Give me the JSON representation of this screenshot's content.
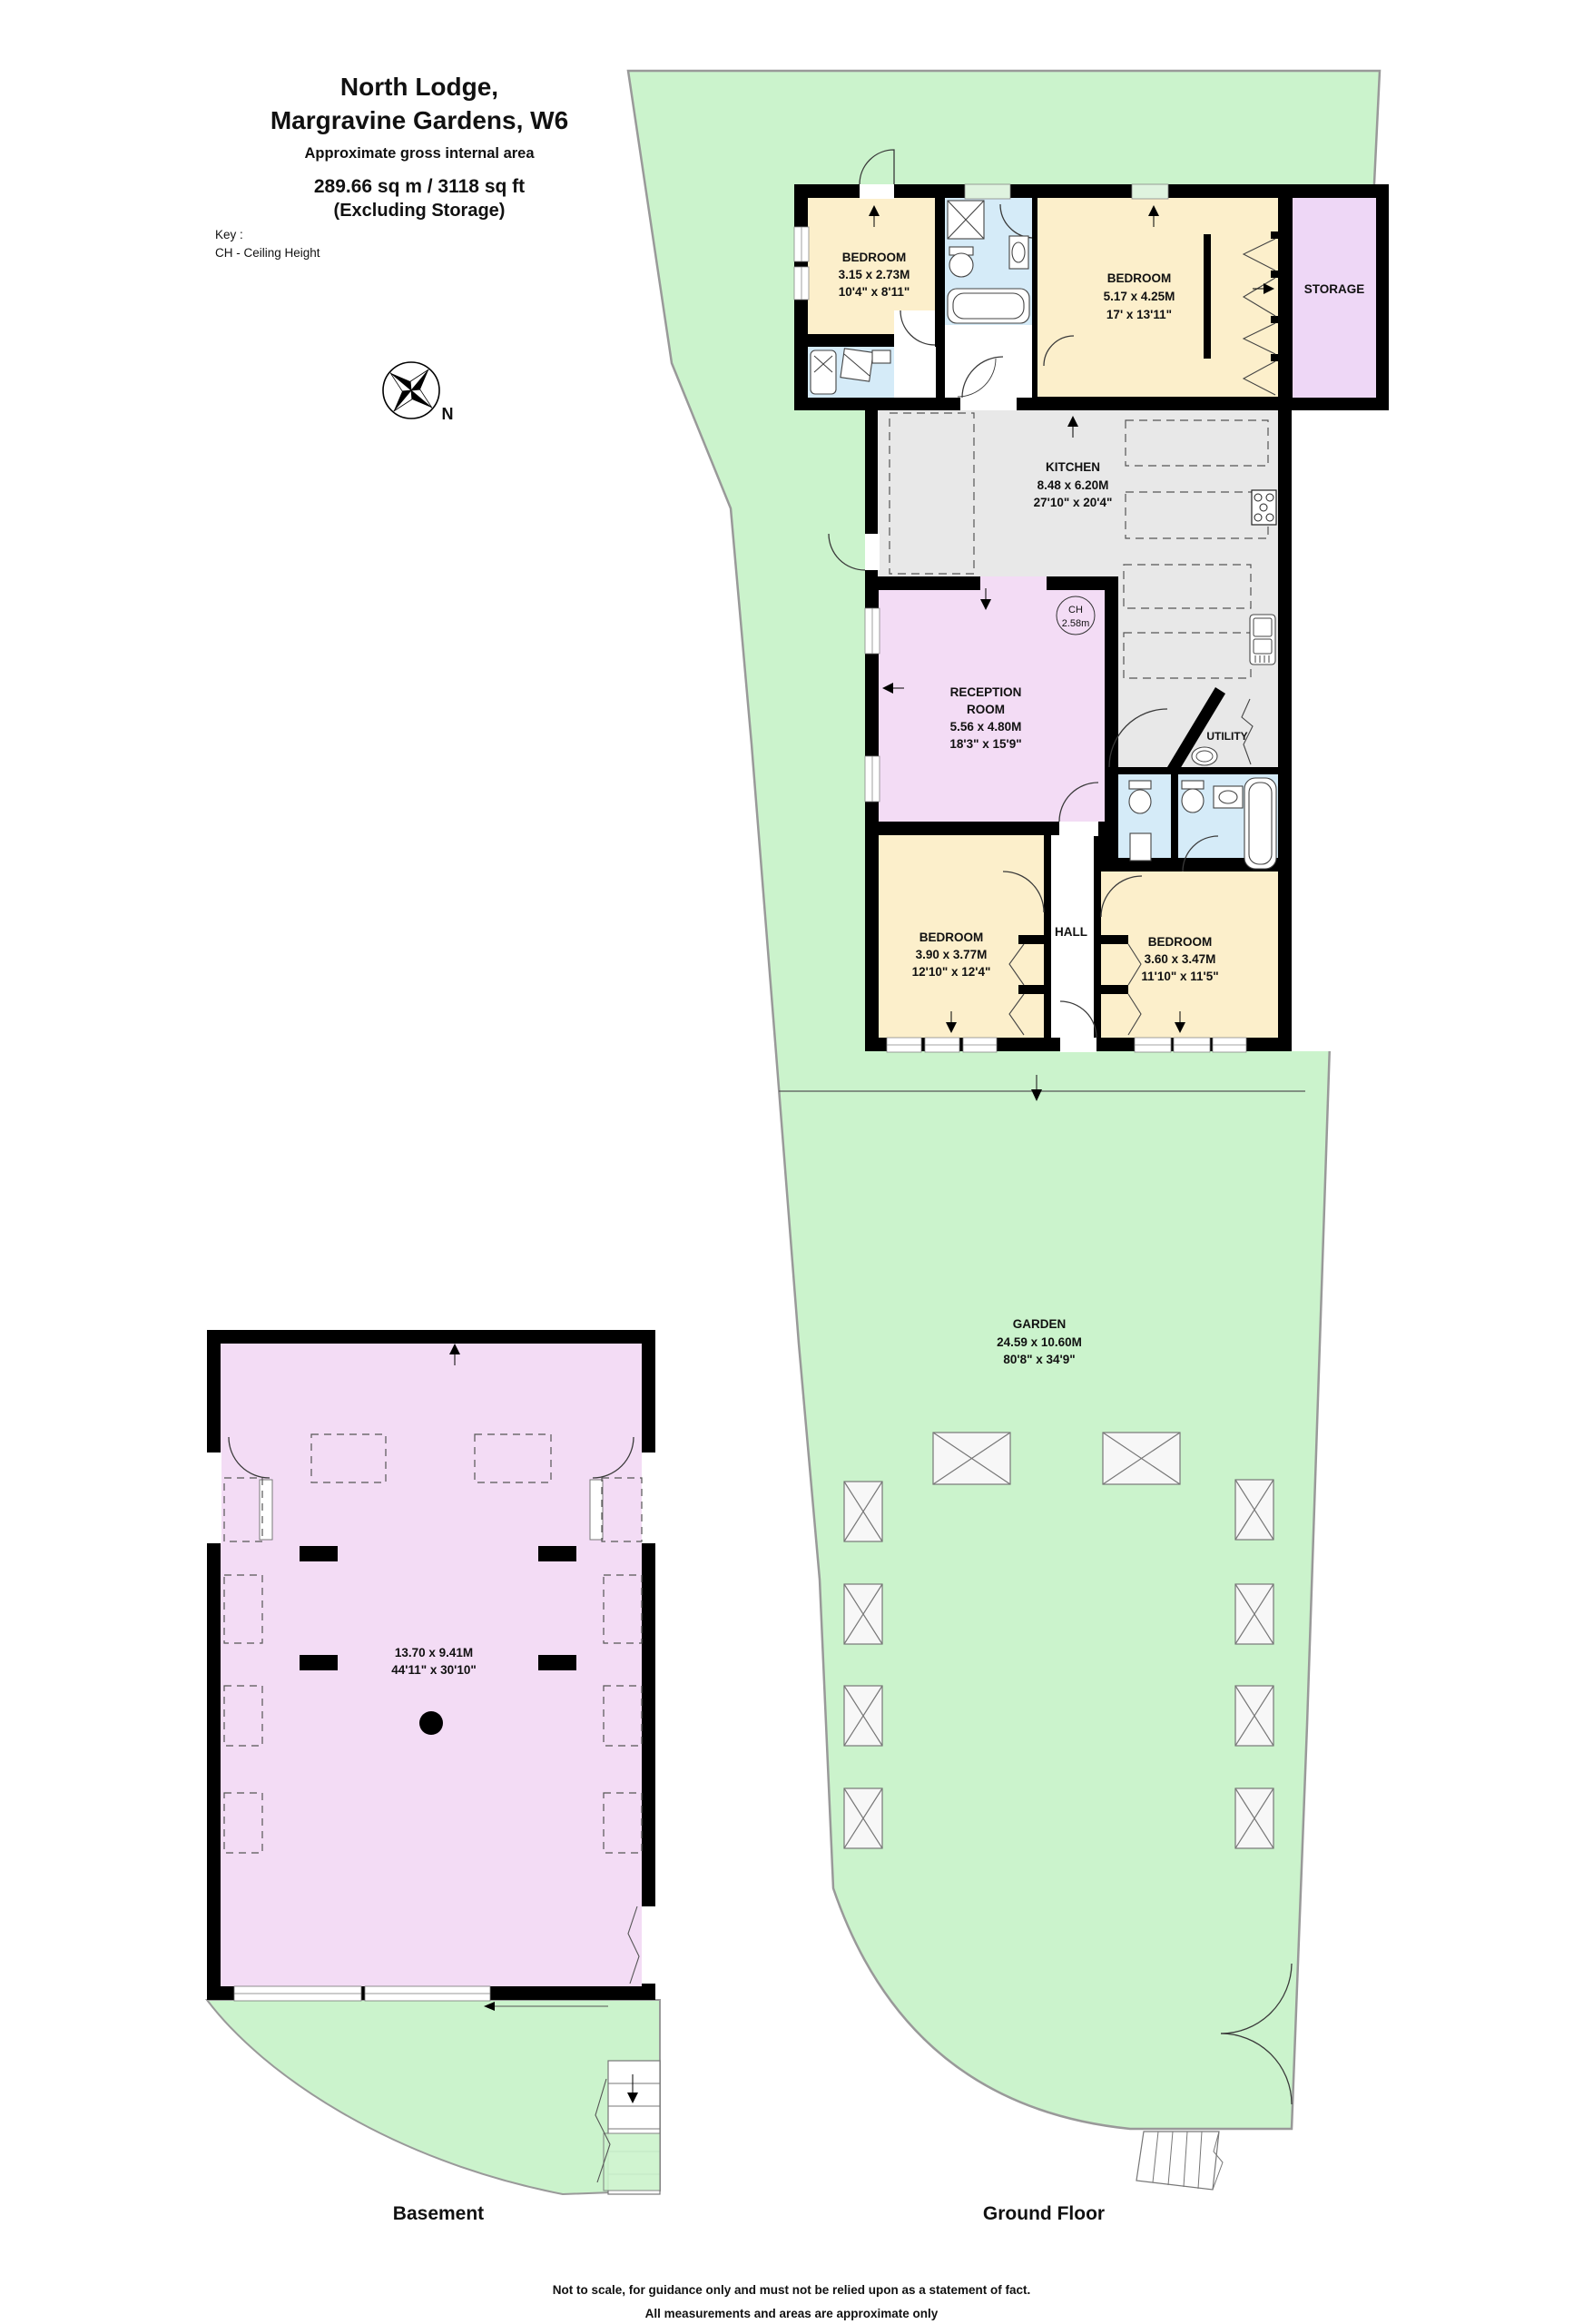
{
  "title": {
    "line1": "North Lodge,",
    "line2": "Margravine Gardens, W6",
    "subtitle": "Approximate gross internal area",
    "area": "289.66 sq m /  3118 sq ft",
    "note": "(Excluding Storage)"
  },
  "key": {
    "line1": "Key :",
    "line2": "CH - Ceiling Height"
  },
  "compass": {
    "north": "N"
  },
  "ground_floor": {
    "label": "Ground Floor",
    "rooms": {
      "bedroom1": {
        "name": "BEDROOM",
        "metric": "3.15 x 2.73M",
        "imperial": "10'4\" x 8'11\""
      },
      "bedroom2": {
        "name": "BEDROOM",
        "metric": "5.17 x 4.25M",
        "imperial": "17' x 13'11\""
      },
      "storage": {
        "name": "STORAGE"
      },
      "kitchen": {
        "name": "KITCHEN",
        "metric": "8.48 x 6.20M",
        "imperial": "27'10\" x 20'4\""
      },
      "reception": {
        "name": "RECEPTION",
        "name2": "ROOM",
        "metric": "5.56 x 4.80M",
        "imperial": "18'3\" x 15'9\""
      },
      "utility": {
        "name": "UTILITY"
      },
      "hall": {
        "name": "HALL"
      },
      "bedroom3": {
        "name": "BEDROOM",
        "metric": "3.90 x 3.77M",
        "imperial": "12'10\" x 12'4\""
      },
      "bedroom4": {
        "name": "BEDROOM",
        "metric": "3.60 x 3.47M",
        "imperial": "11'10\" x 11'5\""
      },
      "garden": {
        "name": "GARDEN",
        "metric": "24.59 x 10.60M",
        "imperial": "80'8\" x 34'9\""
      },
      "ceiling_height": {
        "abbr": "CH",
        "value": "2.58m"
      }
    }
  },
  "basement": {
    "label": "Basement",
    "metric": "13.70 x 9.41M",
    "imperial": "44'11\" x 30'10\""
  },
  "footer": {
    "line1": "Not to scale, for guidance only and must not be relied upon as a statement of fact.",
    "line2": "All measurements and areas are approximate only"
  },
  "colors": {
    "garden": "#cbf3cc",
    "room_pink": "#f3dcf5",
    "room_cream": "#fcefcb",
    "room_blue": "#d5ebf8",
    "room_gray": "#e8e8e8",
    "wall": "#000000"
  }
}
